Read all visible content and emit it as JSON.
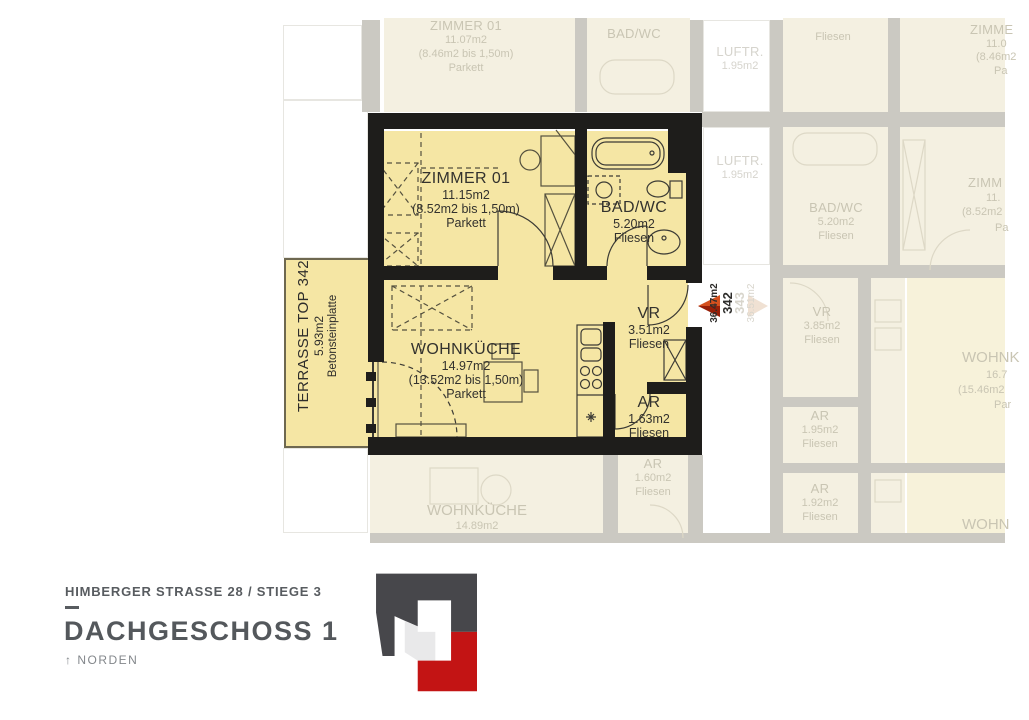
{
  "unit": {
    "rooms": {
      "zimmer": {
        "name": "ZIMMER 01",
        "area": "11.15m2",
        "partial": "(8.52m2 bis 1,50m)",
        "floor": "Parkett"
      },
      "bad": {
        "name": "BAD/WC",
        "area": "5.20m2",
        "floor": "Fliesen"
      },
      "wohnkueche": {
        "name": "WOHNKÜCHE",
        "area": "14.97m2",
        "partial": "(13.52m2 bis 1,50m)",
        "floor": "Parkett"
      },
      "vr": {
        "name": "VR",
        "area": "3.51m2",
        "floor": "Fliesen"
      },
      "ar": {
        "name": "AR",
        "area": "1.63m2",
        "floor": "Fliesen"
      }
    },
    "terrace": {
      "name": "TERRASSE TOP 342",
      "area": "5.93m2",
      "material": "Betonsteinplatte"
    },
    "marker": {
      "area": "36.47m2",
      "top_number": "342"
    },
    "marker_faded": {
      "top_number": "343",
      "area": "36.51m2"
    }
  },
  "background": {
    "top_zimmer": {
      "name": "ZIMMER 01",
      "area": "11.07m2",
      "partial": "(8.46m2 bis 1,50m)",
      "floor": "Parkett"
    },
    "top_bad": {
      "name": "BAD/WC"
    },
    "top_fliesen": {
      "floor": "Fliesen"
    },
    "luftraum1": {
      "name": "LUFTR.",
      "area": "1.95m2"
    },
    "luftraum2": {
      "name": "LUFTR.",
      "area": "1.95m2"
    },
    "right_top": {
      "name": "ZIMME",
      "area": "11.0",
      "partial": "(8.46m2",
      "floor": "Pa"
    },
    "bad_343": {
      "name": "BAD/WC",
      "area": "5.20m2",
      "floor": "Fliesen"
    },
    "right_mid": {
      "name": "ZIMM",
      "area": "11.",
      "partial": "(8.52m2",
      "floor": "Pa"
    },
    "vr_343": {
      "name": "VR",
      "area": "3.85m2",
      "floor": "Fliesen"
    },
    "right_wohn": {
      "name": "WOHNK",
      "area": "16.7",
      "partial": "(15.46m2",
      "floor": "Par"
    },
    "ar_343a": {
      "name": "AR",
      "area": "1.95m2",
      "floor": "Fliesen"
    },
    "ar_343b": {
      "name": "AR",
      "area": "1.92m2",
      "floor": "Fliesen"
    },
    "right_wohn2": {
      "name": "WOHN"
    },
    "bottom_wohnkueche": {
      "name": "WOHNKÜCHE",
      "area": "14.89m2"
    },
    "bottom_ar": {
      "name": "AR",
      "area": "1.60m2",
      "floor": "Fliesen"
    }
  },
  "footer": {
    "address": "HIMBERGER STRASSE 28 / STIEGE 3",
    "floor_title": "DACHGESCHOSS 1",
    "north_arrow": "↑",
    "north_label": "NORDEN"
  },
  "colors": {
    "unit_fill": "#f5e6a4",
    "wall_black": "#1e1d1b",
    "marker_red": "#c63812",
    "logo_dark": "#47474b",
    "logo_red": "#c31414"
  }
}
